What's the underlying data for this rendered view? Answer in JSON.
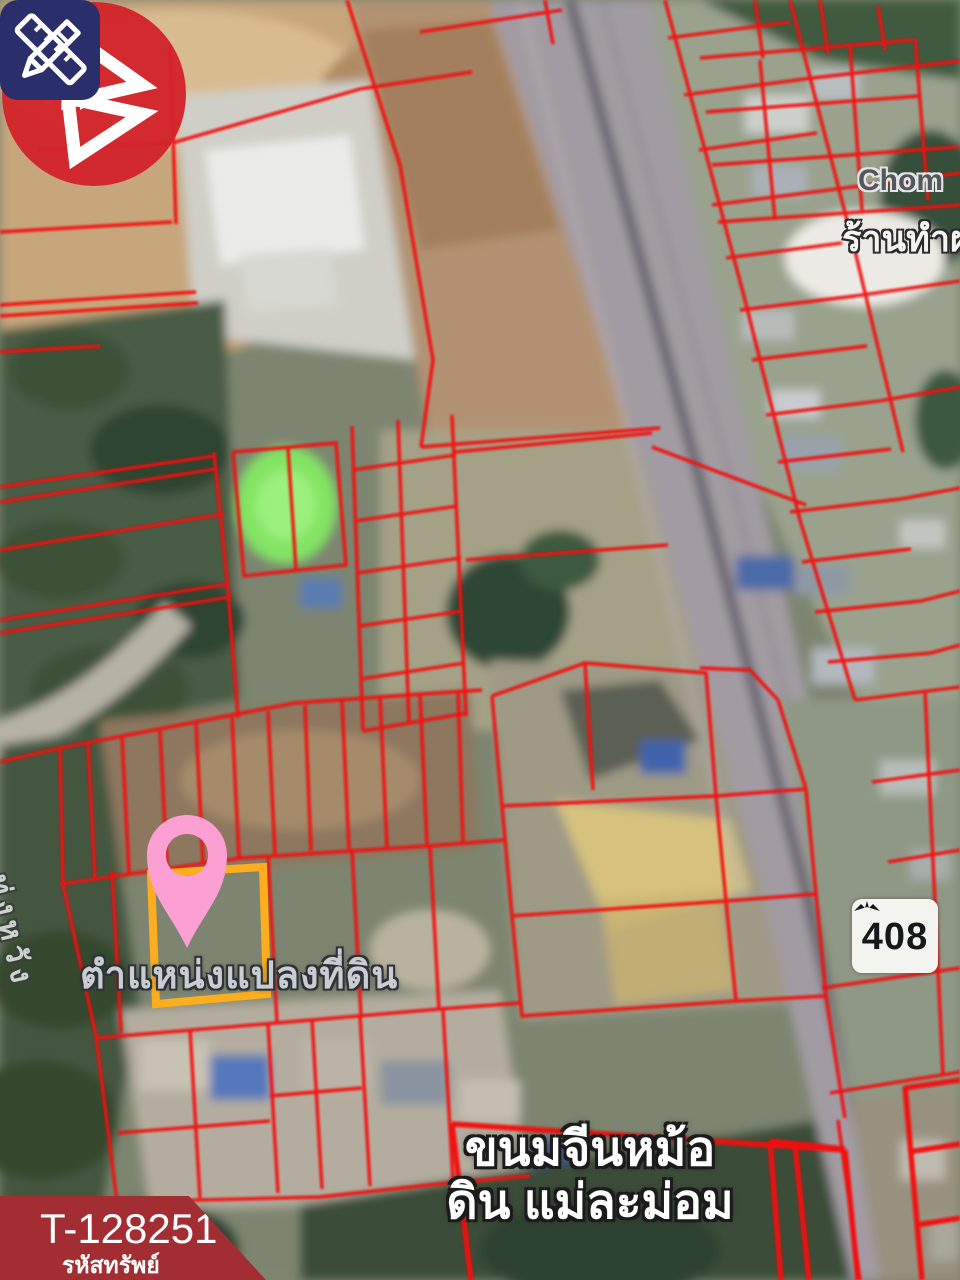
{
  "map_overlay": {
    "parcel_location_label": "ตำแหน่งแปลงที่ดิน",
    "road_name_label": "ทุ่งหวัง",
    "route_shield_number": "408",
    "restaurant_label_line1": "ขนมจีนหม้อ",
    "restaurant_label_line2": "ดิน แม่ละม่อม",
    "partial_place_name_latin": "Chom",
    "partial_place_name_thai": "ร้านทำผ"
  },
  "property_badge": {
    "code": "T-128251",
    "caption": "รหัสทรัพย์"
  },
  "colors": {
    "parcel_line_red": "#f30b0b",
    "highlight_rect_orange": "#fcae1e",
    "pin_pink": "#fc9fd3",
    "brand_red": "#d2232b",
    "edit_icon_navy": "#2a2e6a",
    "banner_maroon": "#a22e34",
    "poi_orange": "#ef8f28",
    "route_shield_bg": "#f3f3ef"
  },
  "icons": {
    "top_left": "pencil-ruler-icon",
    "top_right": "brand-logo-mark",
    "marker": "map-pin-icon",
    "poi": "restaurant-poi-icon"
  }
}
